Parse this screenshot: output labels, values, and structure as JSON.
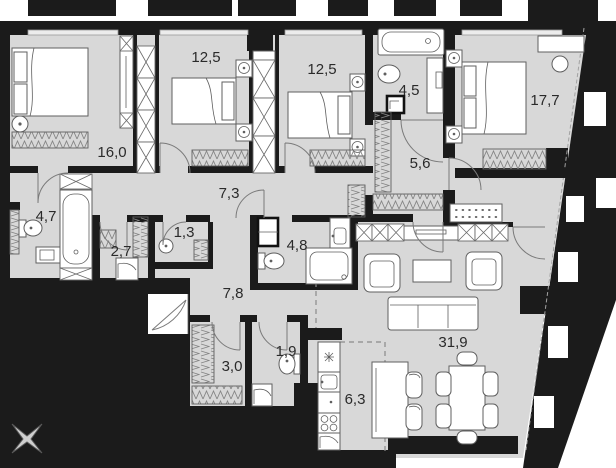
{
  "plan": {
    "rooms": [
      {
        "name": "bedroom-1",
        "area": "16,0"
      },
      {
        "name": "bedroom-2",
        "area": "12,5"
      },
      {
        "name": "bedroom-3",
        "area": "12,5"
      },
      {
        "name": "bathroom-1",
        "area": "4,5"
      },
      {
        "name": "bedroom-4",
        "area": "17,7"
      },
      {
        "name": "hall-1",
        "area": "5,6"
      },
      {
        "name": "corridor",
        "area": "7,3"
      },
      {
        "name": "bathroom-2",
        "area": "4,7"
      },
      {
        "name": "storage",
        "area": "1,3"
      },
      {
        "name": "laundry",
        "area": "2,7"
      },
      {
        "name": "bathroom-3",
        "area": "4,8"
      },
      {
        "name": "hallway",
        "area": "7,8"
      },
      {
        "name": "wardrobe",
        "area": "3,0"
      },
      {
        "name": "wc",
        "area": "1,9"
      },
      {
        "name": "kitchen",
        "area": "6,3"
      },
      {
        "name": "living-room",
        "area": "31,9"
      }
    ],
    "colors": {
      "wall": "#1b1b1b",
      "floor": "#d8d8d8",
      "outline": "#5f5f5f",
      "label": "#2a2a2a",
      "bg": "#ffffff"
    },
    "icons": {
      "compass": "compass-rose-icon"
    }
  }
}
